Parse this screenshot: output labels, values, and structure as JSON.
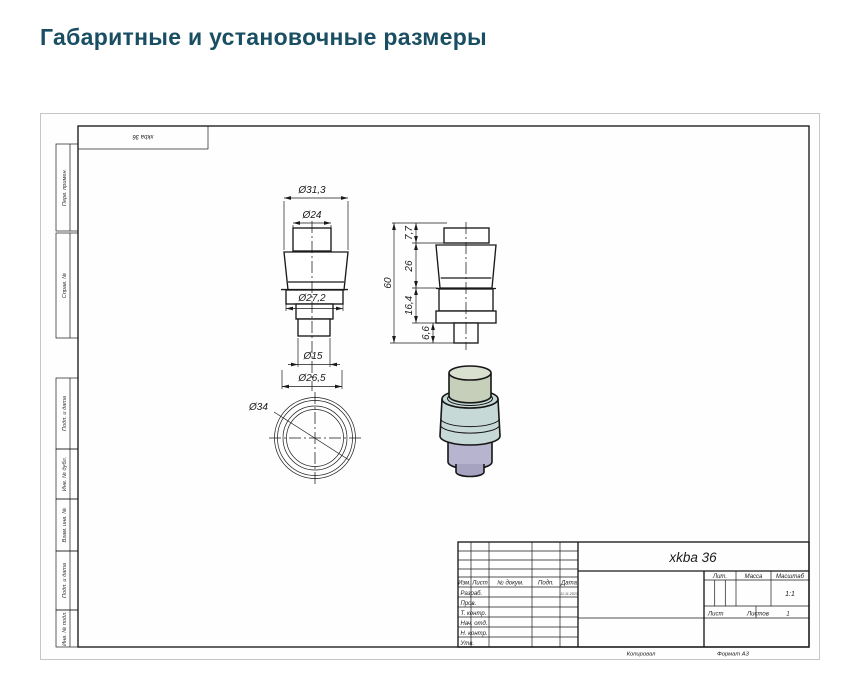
{
  "page": {
    "title": "Габаритные и установочные размеры"
  },
  "sheet": {
    "top_stamp": "xkba 36",
    "margin_labels": {
      "perv_primen": "Перв. примен.",
      "sprav_no": "Справ. №",
      "podp_data_1": "Подп. и дата",
      "inv_no_dubl": "Инв. № дубл.",
      "vzam_inv_no": "Взам. инв. №",
      "podp_data_2": "Подп. и дата",
      "inv_no_podl": "Инв. № подл."
    },
    "footer": {
      "copied_by": "Копировал",
      "format": "Формат А3"
    }
  },
  "views": {
    "front": {
      "dia_top": "Ø31,3",
      "dia_cap": "Ø24",
      "dia_body": "Ø27,2",
      "dia_stem": "Ø15",
      "dia_base": "Ø26,5"
    },
    "side": {
      "h_cap": "7,7",
      "h_taper": "26",
      "h_body": "16,4",
      "h_stem": "6,6",
      "h_total": "60"
    },
    "bottom": {
      "dia_outer": "Ø34"
    }
  },
  "title_block": {
    "designation": "xkba 36",
    "cols": {
      "izm": "Изм.",
      "list": "Лист",
      "doc_no": "№ докум.",
      "podp": "Подп.",
      "data": "Дата"
    },
    "rows": {
      "razrab": "Разраб.",
      "prov": "Пров.",
      "t_kontr": "Т. контр.",
      "nach_otd": "Нач. отд.",
      "n_kontr": "Н. контр.",
      "utv": "Утв."
    },
    "razrab_date": "11.11.2023",
    "lit": "Лит.",
    "massa": "Масса",
    "masshtab": "Масштаб",
    "scale": "1:1",
    "list_label": "Лист",
    "listov_label": "Листов",
    "listov_value": "1"
  },
  "colors": {
    "title_text": "#1a4e63",
    "cap_top": "#dae0cf",
    "cap_side": "#c6cfba",
    "body": "#c7d9d6",
    "body_dark": "#b4cdc6",
    "base": "#b6b4cf",
    "base_dark": "#a6a3c1"
  }
}
